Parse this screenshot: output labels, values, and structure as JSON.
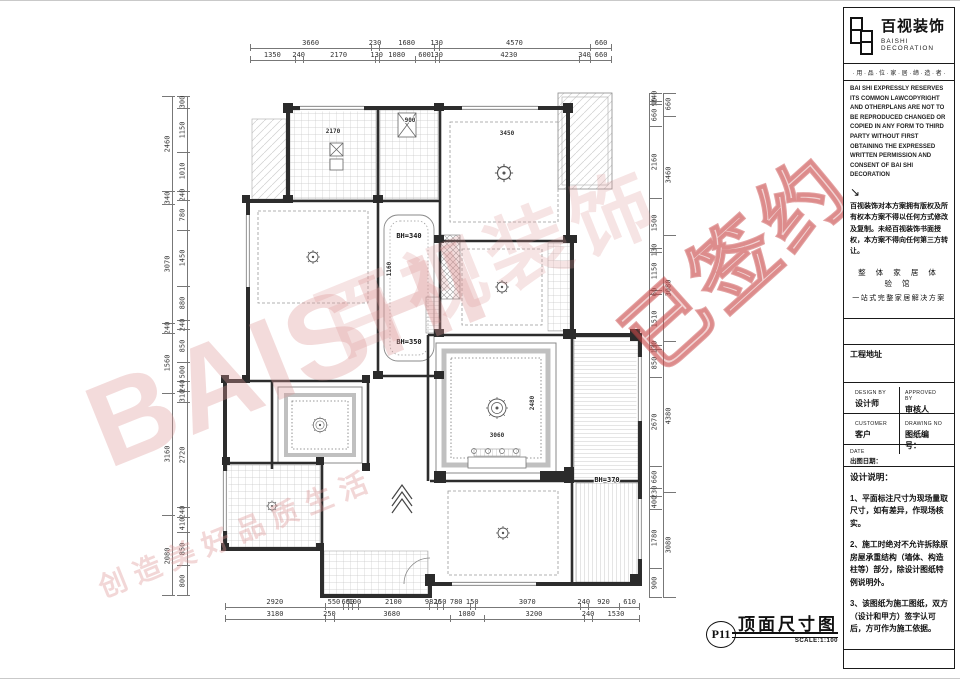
{
  "watermarks": {
    "big": "BAISHI",
    "seal": "已签约",
    "brand": "百视装饰",
    "slogan": "创造美好品质生活"
  },
  "plan": {
    "bh1": "BH=340",
    "bh2": "BH=350",
    "bh3": "BH=370",
    "room_dims": [
      {
        "v": "2170"
      },
      {
        "v": "3450"
      },
      {
        "v": "900"
      },
      {
        "v": "3060"
      },
      {
        "v": "2480"
      },
      {
        "v": "1160"
      }
    ]
  },
  "dims": {
    "top1": [
      "3660",
      "230",
      "1680",
      "130",
      "4570",
      "660"
    ],
    "top2": [
      "1350",
      "240",
      "2170",
      "130",
      "1080",
      "600",
      "130",
      "4230",
      "340",
      "660"
    ],
    "bottom1": [
      "2920",
      "550",
      {
        "v": "60",
        "w": 140
      },
      {
        "v": "50",
        "w": 120
      },
      {
        "v": "100",
        "w": 160
      },
      "2100",
      {
        "v": "9826",
        "w": 240
      },
      {
        "v": "150",
        "w": 160
      },
      "780",
      {
        "v": "150",
        "w": 160
      },
      "3070",
      "240",
      "920",
      "610"
    ],
    "bottom2": [
      "3180",
      {
        "v": "250",
        "w": 280
      },
      "3680",
      "1080",
      "3200",
      "240",
      "1530"
    ],
    "left_outer": [
      "2460",
      "340",
      "3070",
      "240",
      "1560",
      "3160",
      "2080"
    ],
    "left_inner": [
      "300",
      "1150",
      "1010",
      "240",
      "780",
      "1450",
      "880",
      "240",
      "850",
      "500",
      "240",
      "310",
      "2720",
      "240",
      "410",
      "850",
      "800"
    ],
    "right_inner": [
      "240",
      "90",
      "660",
      "2160",
      "1500",
      "130",
      "1150",
      {
        "v": "60",
        "w": 120
      },
      "1510",
      "130",
      "850",
      "2670",
      "660",
      "230",
      "400",
      "1780",
      "900"
    ],
    "right_outer": [
      "660",
      "3460",
      "3080",
      "4380",
      "3080"
    ]
  },
  "footer": {
    "page_no": "P11",
    "title": "顶面尺寸图",
    "scale": "SCALE:1:100"
  },
  "titleblock": {
    "brand": "百视装饰",
    "brand_en": "BAISHI DECORATION",
    "tagline": "· 用 · 品 · 位 · 家 · 居 · 缔 · 造 · 者 ·",
    "legal_en": "BAI SHI EXPRESSLY RESERVES ITS COMMON LAWCOPYRIGHT AND OTHERPLANS ARE NOT TO BE REPRODUCED CHANGED OR COPIED IN ANY FORM TO THIRD PARTY WITHOUT FIRST OBTAINING THE EXPRESSED WRITTEN PERMISSION AND CONSENT OF BAI SHI DECORATION",
    "arrow": "↘",
    "legal_cn": "百视装饰对本方案拥有版权及所有权本方案不得以任何方式修改及复制。未经百视装饰书面授权，本方案不得向任何第三方转让。",
    "slogan1": "整 体 家 居 体 验 馆",
    "slogan2": "一站式完整家居解决方案",
    "address_label": "工程地址",
    "design_by_en": "DESIGN BY",
    "design_by": "设计师",
    "approved_en": "APPROVED BY",
    "approved": "审核人",
    "customer_en": "CUSTOMER",
    "customer": "客户",
    "drawing_no_en": "DRAWING NO",
    "drawing_no": "图纸编号：",
    "date_en": "DATE",
    "date": "出图日期：",
    "notes_title": "设计说明：",
    "notes": [
      "1、平面标注尺寸为现场量取尺寸，如有差异，作现场核实。",
      "2、施工时绝对不允许拆除原房屋承重结构（墙体、构造柱等）部分，除设计图纸特例说明外。",
      "3、该图纸为施工图纸，双方（设计和甲方）签字认可后，方可作为施工依据。"
    ]
  }
}
